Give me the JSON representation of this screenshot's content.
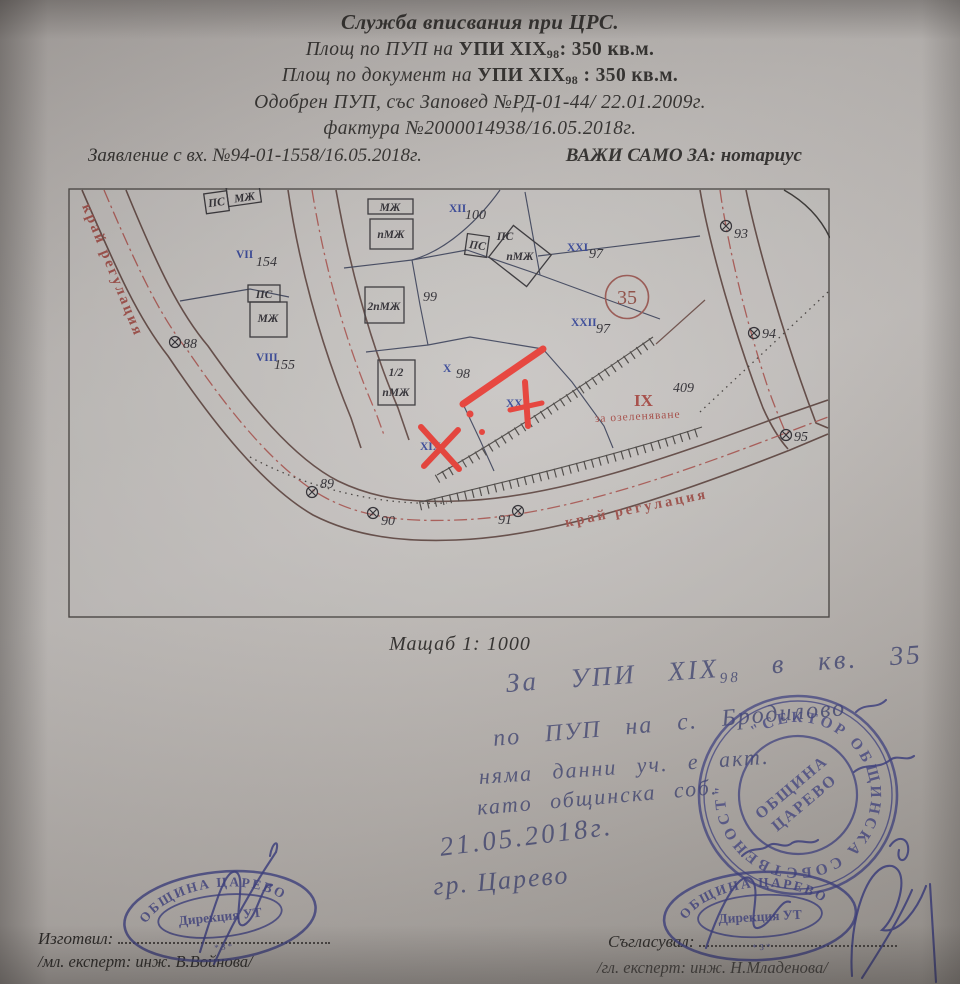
{
  "header": {
    "line1": "Служба вписвания при ЦРС.",
    "line2_prefix": "Площ по ПУП на ",
    "line2_plot": "УПИ XIX",
    "line2_sub": "98",
    "line2_suffix": ": 350 кв.м.",
    "line3_prefix": "Площ по документ на ",
    "line3_plot": "УПИ XIX",
    "line3_sub": "98",
    "line3_suffix": " : 350 кв.м.",
    "line4": "Одобрен ПУП, със Заповед №РД-01-44/ 22.01.2009г.",
    "line5": "фактура №2000014938/16.05.2018г.",
    "line6_left": "Заявление с вх. №94-01-1558/16.05.2018г.",
    "line6_right": "ВАЖИ САМО ЗА: нотариус"
  },
  "map": {
    "scale_label": "Мащаб 1: 1000",
    "edge_label_left": "край регулация",
    "edge_label_bottom": "край регулация",
    "zone_circle": "35",
    "green_zone": {
      "roman": "IX",
      "label": "за озеленяване",
      "number": "409"
    },
    "free_number_99": "99",
    "plots": [
      {
        "roman": "VII",
        "number": "154"
      },
      {
        "roman": "VIII",
        "number": "155"
      },
      {
        "roman": "XII",
        "number": "100"
      },
      {
        "roman": "XXI",
        "number": "97"
      },
      {
        "roman": "XXII",
        "number": "97"
      },
      {
        "roman": "X",
        "number": "98"
      },
      {
        "roman": "XX",
        "number": ""
      },
      {
        "roman": "XIX",
        "number": ""
      }
    ],
    "buildings": [
      "ПС",
      "МЖ",
      "МЖ",
      "пМЖ",
      "ПС",
      "МЖ",
      "2пМЖ",
      "1/2",
      "пМЖ",
      "ПС",
      "пМЖ",
      "ПС"
    ],
    "points": [
      "88",
      "89",
      "90",
      "91",
      "93",
      "94",
      "95"
    ],
    "colors": {
      "red_mark": "#e5342c",
      "regulation_text": "#9c4a44",
      "boundary_blue": "#3a4058",
      "road_brown": "#5d443f",
      "ink_blue": "#3c3f85"
    }
  },
  "notes": {
    "line1a": "За УПИ XIX",
    "line1sub": "98",
    "line1b": " в кв. 35",
    "line2": "по ПУП на с. Бродилово",
    "line3": "няма данни уч. е акт.",
    "line4": "като общинска соб.",
    "date": "21.05.2018г.",
    "city": "гр. Царево"
  },
  "stamps": {
    "round_ring": "\"СЕКТОР ОБЩИНСКА СОБСТВЕНОСТ\"",
    "round_center1": "ОБЩИНА",
    "round_center2": "ЦАРЕВО",
    "oval_top": "ОБЩИНА ЦАРЕВО",
    "oval_center": "Дирекция УТ",
    "oval_bottom": "*  З  *"
  },
  "footer": {
    "left_label": "Изготвил:",
    "left_name": "/мл. експерт: инж. В.Войнова/",
    "right_label": "Съгласувал:",
    "right_name": "/гл. експерт: инж. Н.Младенова/"
  }
}
